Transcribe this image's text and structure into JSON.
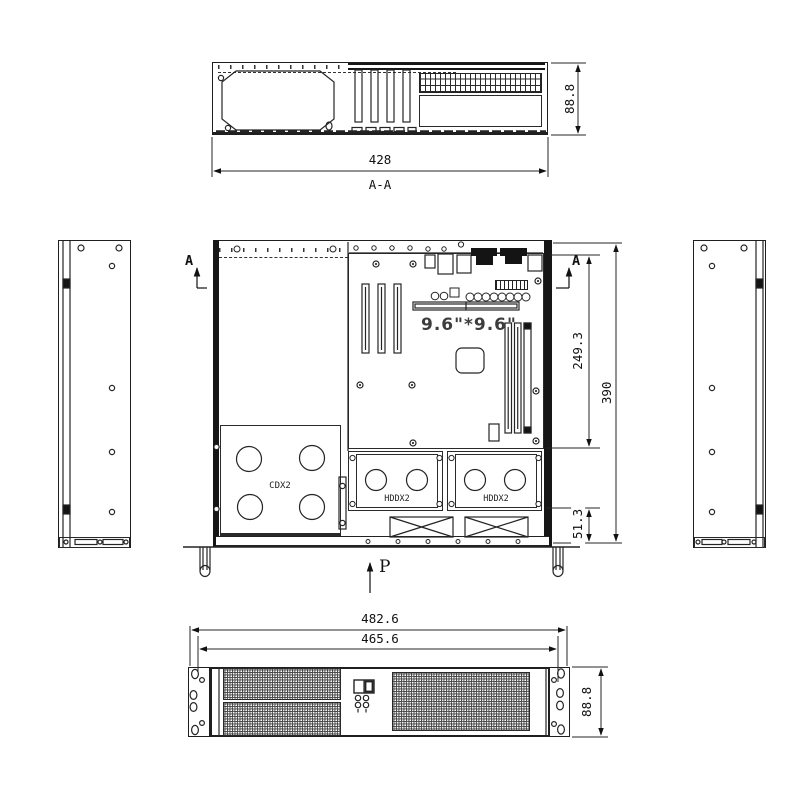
{
  "drawing": {
    "section_view": {
      "height_dim": "88.8",
      "width_dim": "428",
      "label": "A-A"
    },
    "plan_view": {
      "board_size_text": "9.6\"*9.6\"",
      "cd_bay_label": "CDX2",
      "hdd_bay1_label": "HDDX2",
      "hdd_bay2_label": "HDDX2",
      "board_depth_dim": "249.3",
      "total_depth_dim": "390",
      "fan_zone_dim": "51.3",
      "pressure_label": "P",
      "section_mark_left": "A",
      "section_mark_right": "A"
    },
    "front_view": {
      "outer_width_dim": "482.6",
      "inner_width_dim": "465.6",
      "height_dim": "88.8"
    },
    "line_color": "#1f1f1f"
  }
}
